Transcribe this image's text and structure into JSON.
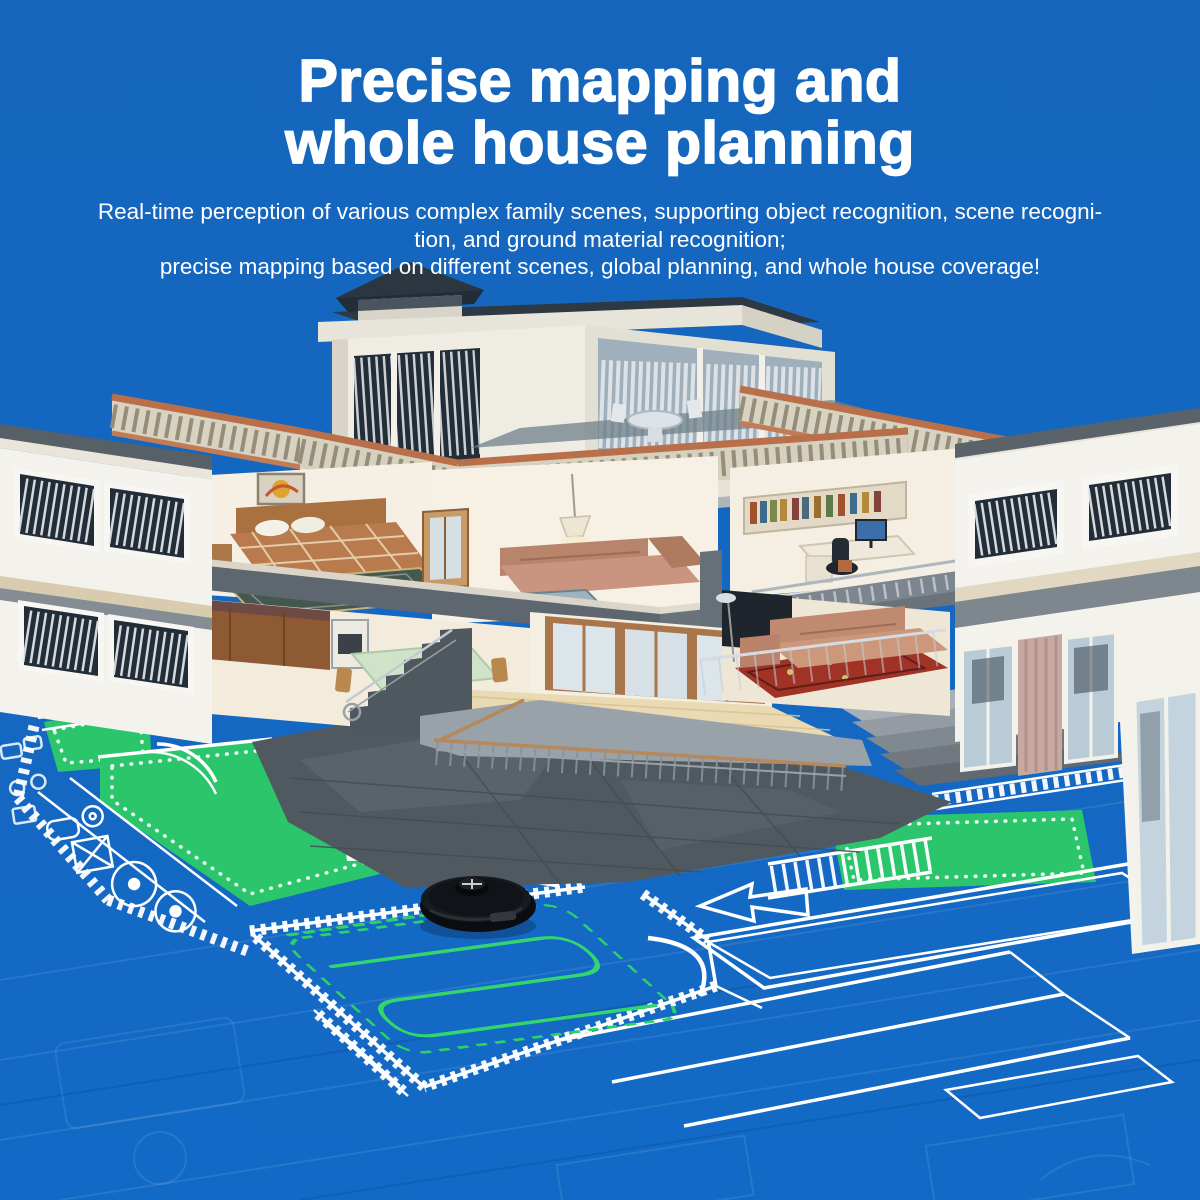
{
  "header": {
    "title_line1": "Precise mapping and",
    "title_line2": "whole house planning",
    "subtitle_line1": "Real-time perception of various complex family scenes, supporting object recognition, scene recogni-",
    "subtitle_line2": "tion, and ground material recognition;",
    "subtitle_line3": "precise mapping based on different scenes, global planning, and whole house coverage!"
  },
  "colors": {
    "background": "#1566BE",
    "blueprint_line": "#FFFFFF",
    "mapped_area_green": "#2BC66B",
    "cleaning_path_green": "#33D66E",
    "house_wall_cream": "#F2F0E8",
    "roof_dark": "#2E3943",
    "terracotta_rail": "#B96F49",
    "stone_grey": "#565E66",
    "robot_black": "#0B0D10"
  }
}
